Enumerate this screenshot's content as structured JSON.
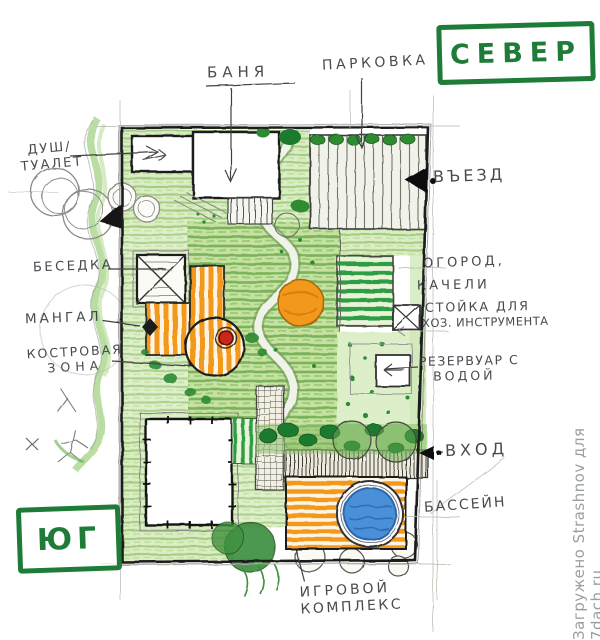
{
  "compass": {
    "north": "СЕВЕР",
    "south": "ЮГ"
  },
  "labels": {
    "banya": "БАНЯ",
    "parkovka": "ПАРКОВКА",
    "vezd": "ВЪЕЗД",
    "dush_line1": "ДУШ/",
    "dush_line2": "ТУАЛЕТ",
    "besedka": "БЕСЕДКА",
    "mangal": "МАНГАЛ",
    "kostrovaya_line1": "КОСТРОВАЯ",
    "kostrovaya_line2": "ЗОНА",
    "ogorod": "ОГОРОД,",
    "kacheli": "КАЧЕЛИ",
    "stoyka": "СТОЙКА ДЛЯ",
    "hoz_instrument": "ХОЗ. ИНСТРУМЕНТА",
    "rezervuar_line1": "РЕЗЕРВУАР С",
    "rezervuar_line2": "ВОДОЙ",
    "vhod": "ВХОД",
    "basseyn": "БАССЕЙН",
    "igrovoy_line1": "ИГРОВОЙ",
    "igrovoy_line2": "КОМПЛЕКС"
  },
  "watermark": "Загружено Strashnov для 7dach.ru",
  "colors": {
    "marker_green": "#1e7c38",
    "lawn_green": "#8fc26d",
    "dark_green": "#1d7a2e",
    "bed_green": "#2f9e45",
    "deck_orange": "#f2991d",
    "pool_blue": "#4a90d8",
    "fire_red": "#c9251c",
    "ink": "#2f3136",
    "pencil": "#6b6b6b",
    "watermark_gray": "#9aa0a0"
  }
}
